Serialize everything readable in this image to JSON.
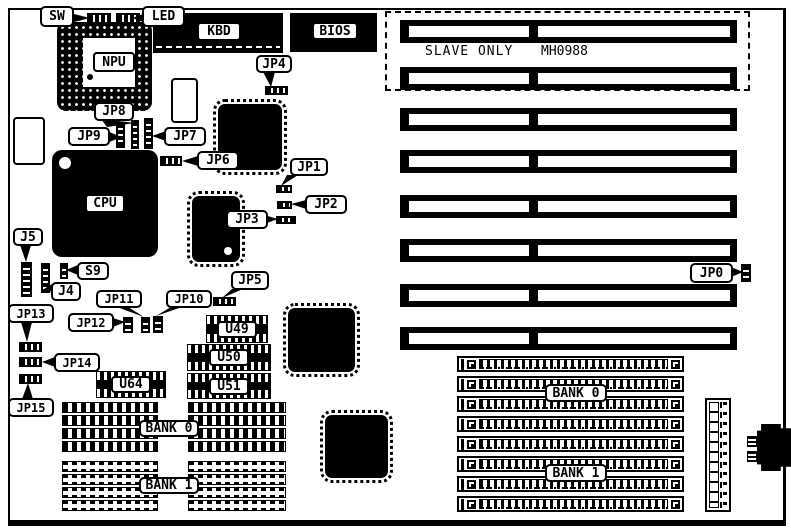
{
  "labels": {
    "sw": "SW",
    "led": "LED",
    "kbd": "KBD",
    "bios": "BIOS",
    "npu": "NPU",
    "cpu": "CPU",
    "jp0": "JP0",
    "jp1": "JP1",
    "jp2": "JP2",
    "jp3": "JP3",
    "jp4": "JP4",
    "jp5": "JP5",
    "jp6": "JP6",
    "jp7": "JP7",
    "jp8": "JP8",
    "jp9": "JP9",
    "jp10": "JP10",
    "jp11": "JP11",
    "jp12": "JP12",
    "jp13": "JP13",
    "jp14": "JP14",
    "jp15": "JP15",
    "j4": "J4",
    "j5": "J5",
    "s9": "S9",
    "u49": "U49",
    "u50": "U50",
    "u51": "U51",
    "u64": "U64",
    "bank0": "BANK 0",
    "bank1": "BANK 1",
    "slave_only": "SLAVE ONLY",
    "part_number": "MH0988"
  },
  "colors": {
    "background": "#ffffff",
    "ink": "#000000"
  }
}
